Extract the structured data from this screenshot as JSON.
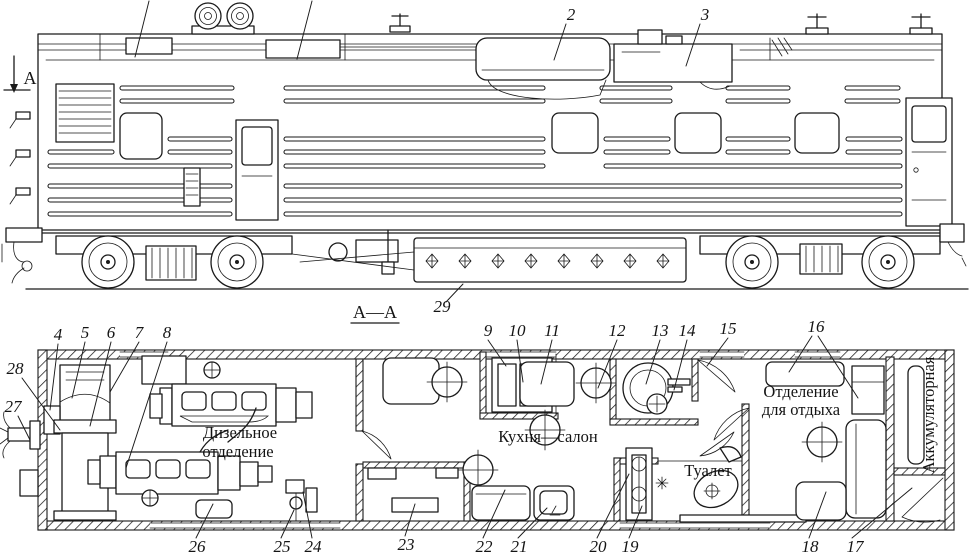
{
  "figure": {
    "title": "Служебный дизельный вагон — боковой вид и план",
    "colors": {
      "ink": "#1a1a1a",
      "paper": "#ffffff"
    }
  },
  "section": {
    "cut_label": "А",
    "plan_label": "А—А"
  },
  "rooms": {
    "diesel_line1": "Дизельное",
    "diesel_line2": "отделение",
    "kitchen": "Кухня—салон",
    "toilet": "Туалет",
    "rest_line1": "Отделение",
    "rest_line2": "для отдыха",
    "battery": "Аккумуляторная"
  },
  "callouts": {
    "n2": "2",
    "n3": "3",
    "n4": "4",
    "n5": "5",
    "n6": "6",
    "n7": "7",
    "n8": "8",
    "n9": "9",
    "n10": "10",
    "n11": "11",
    "n12": "12",
    "n13": "13",
    "n14": "14",
    "n15": "15",
    "n16": "16",
    "n17": "17",
    "n18": "18",
    "n19": "19",
    "n20": "20",
    "n21": "21",
    "n22": "22",
    "n23": "23",
    "n24": "24",
    "n25": "25",
    "n26": "26",
    "n27": "27",
    "n28": "28",
    "n29": "29"
  }
}
